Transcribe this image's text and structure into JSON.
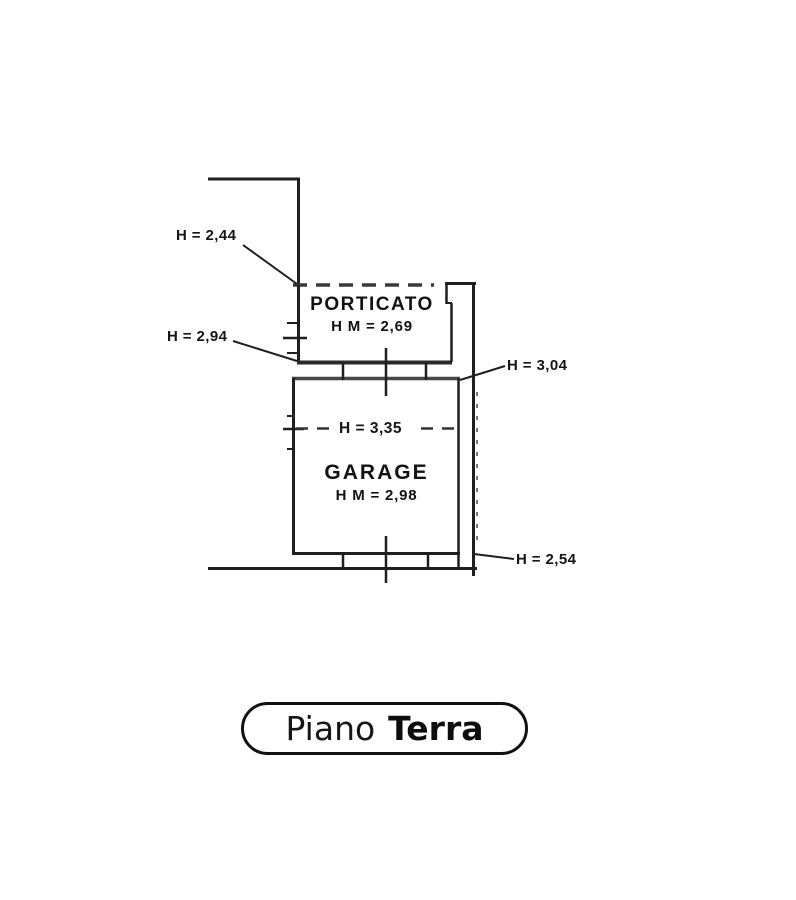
{
  "drawing": {
    "type": "floor-plan-scan",
    "rooms": {
      "porticato": {
        "name": "PORTICATO",
        "height": "H M = 2,69"
      },
      "garage": {
        "name": "GARAGE",
        "height": "H M = 2,98"
      }
    },
    "annotations": {
      "h_2_44": "H = 2,44",
      "h_2_94": "H = 2,94",
      "h_3_04": "H = 3,04",
      "h_2_54": "H = 2,54",
      "h_3_35": "H = 3,35"
    },
    "floor_label": {
      "word1": "Piano",
      "word2": "Terra"
    },
    "colors": {
      "ink": "#1f1f1f",
      "ink_gray": "#4a4a4a",
      "paper": "#ffffff"
    }
  }
}
